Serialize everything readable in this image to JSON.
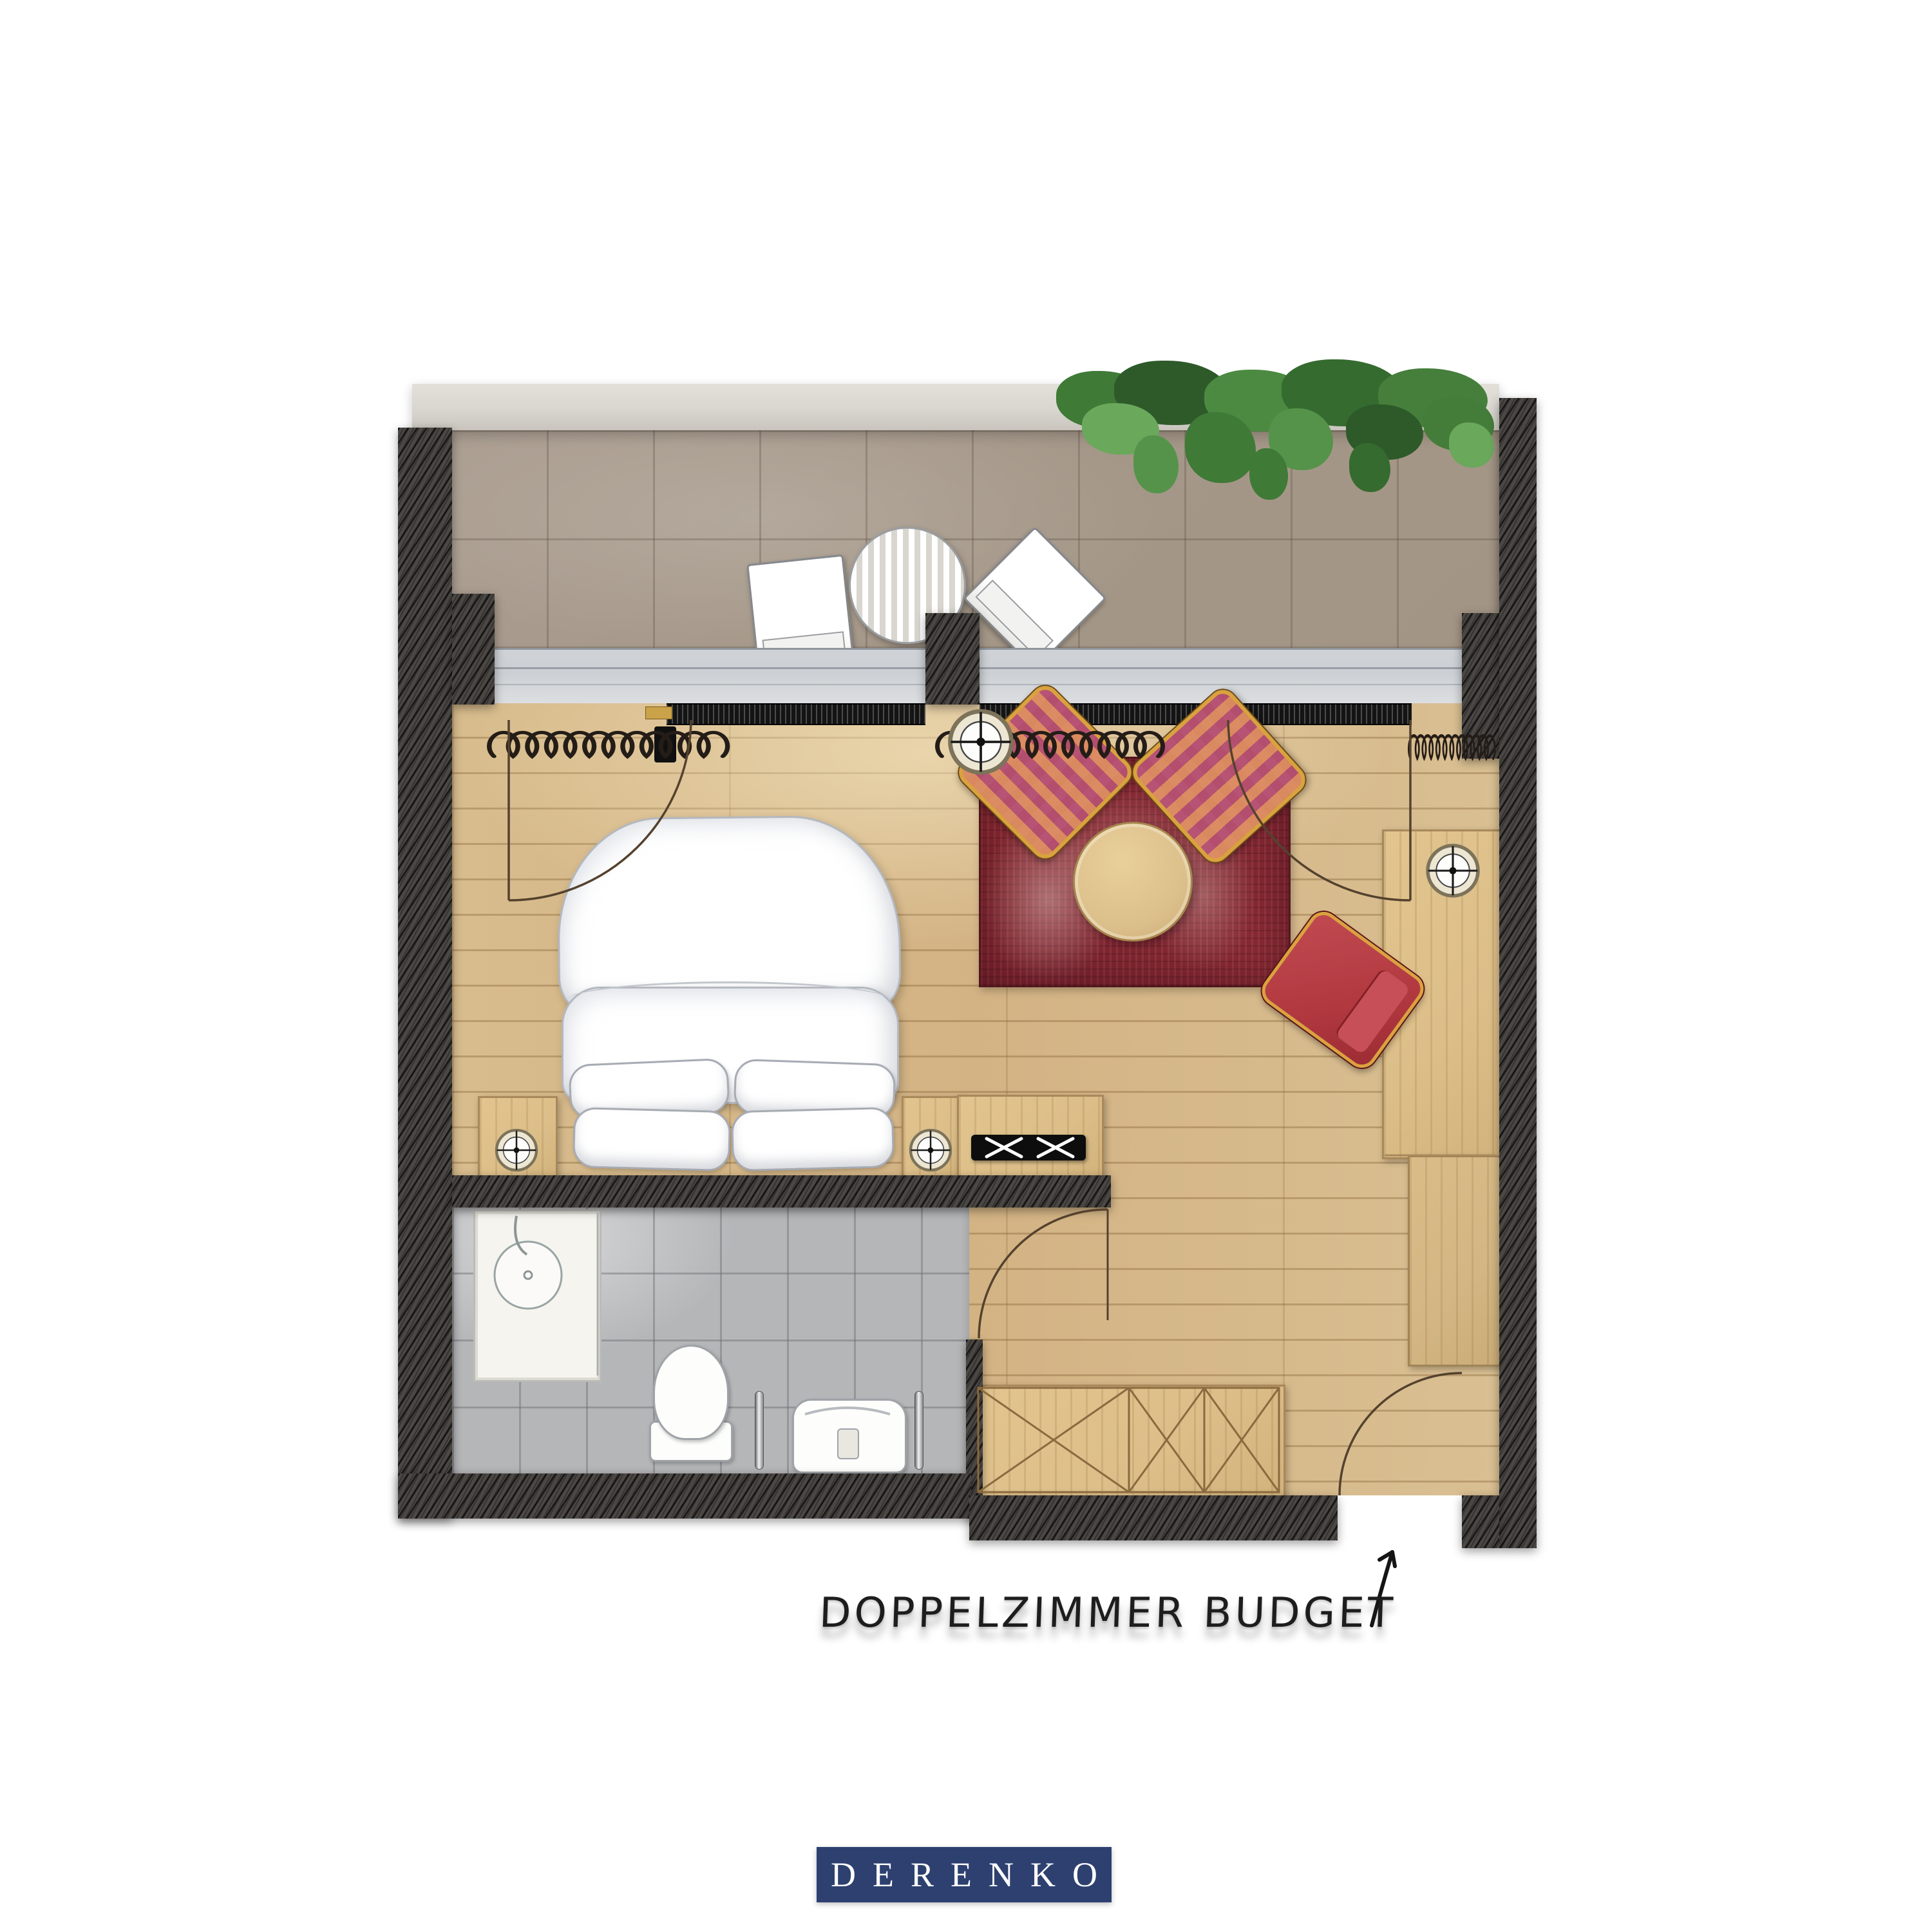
{
  "annotation": {
    "room_label": "DOPPELZIMMER BUDGET"
  },
  "brand": {
    "logo_text": "DERENKO"
  },
  "palette": {
    "wall": "#4a4744",
    "balcony_tile": "#a49788",
    "balcony_edge": "#d9d6d0",
    "window_sill": "#ccd0d4",
    "radiator": "#141414",
    "wood_floor": "#d3b384",
    "wood_furniture": "#dcbe89",
    "rug": "#7f2530",
    "gold_frame": "#d9a23f",
    "desk_chair_red": "#b2383f",
    "bath_tile": "#b5b6b8",
    "logo_bg": "#2d4070",
    "logo_text_color": "#ffffff",
    "label_color": "#1d1d1d",
    "linework": "#54422e",
    "greenery_dark": "#2e5a2a",
    "greenery_mid": "#3f7a37",
    "greenery_light": "#6aa85c"
  },
  "legend_icons": [
    "exterior-wall",
    "terrace-tiles",
    "ivy-plants",
    "folding-chair",
    "terrace-table",
    "window-sill",
    "radiator",
    "curtain",
    "door-swing",
    "double-bed",
    "pillow",
    "nightstand",
    "reading-lamp",
    "floor-lamp",
    "armchair",
    "coffee-table",
    "rug",
    "desk",
    "desk-chair",
    "tv-sideboard",
    "wardrobe",
    "shower",
    "toilet",
    "washbasin",
    "towel-rail",
    "entrance-arrow"
  ]
}
